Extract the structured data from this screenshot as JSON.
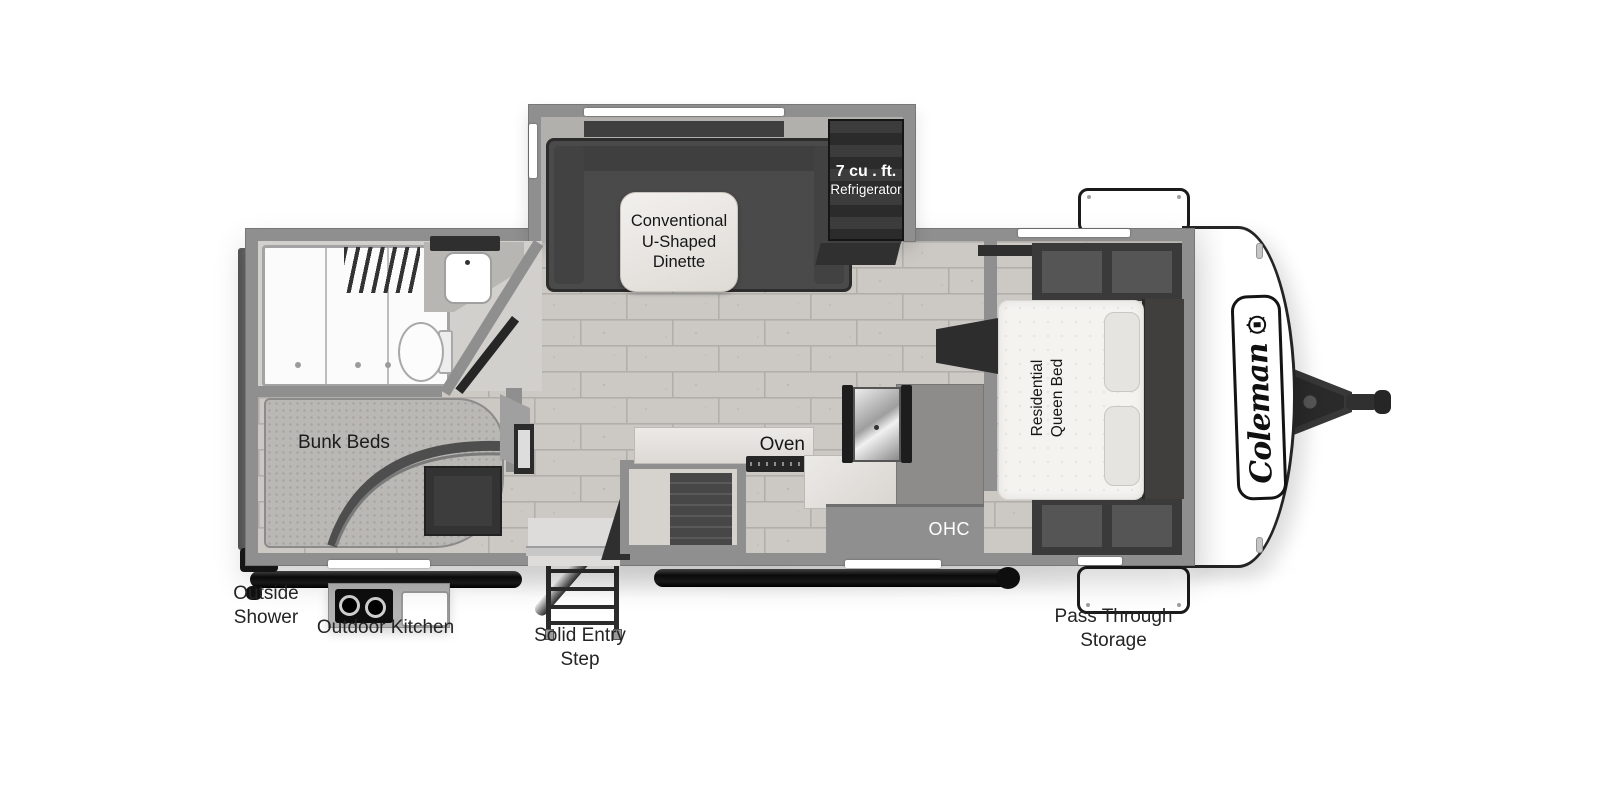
{
  "diagram": {
    "type": "rv-floor-plan",
    "brand": "Coleman"
  },
  "brand": {
    "logo_text": "Coleman"
  },
  "labels": {
    "dinette_l1": "Conventional",
    "dinette_l2": "U-Shaped",
    "dinette_l3": "Dinette",
    "fridge_l1": "7 cu . ft.",
    "fridge_l2": "Refrigerator",
    "bed_l1": "Residential",
    "bed_l2": "Queen Bed",
    "bunks": "Bunk Beds",
    "oven": "Oven",
    "ohc": "OHC",
    "outside_shower_l1": "Outside",
    "outside_shower_l2": "Shower",
    "outdoor_kitchen": "Outdoor Kitchen",
    "entry_step_l1": "Solid Entry",
    "entry_step_l2": "Step",
    "pass_through_l1": "Pass Through",
    "pass_through_l2": "Storage"
  },
  "colors": {
    "background": "#ffffff",
    "wall": "#8f8f8f",
    "floor_brick": "#ccc9c5",
    "furniture_dark": "#3a3a3a",
    "front_cap": "#ffffff",
    "accessory_black": "#111111"
  }
}
